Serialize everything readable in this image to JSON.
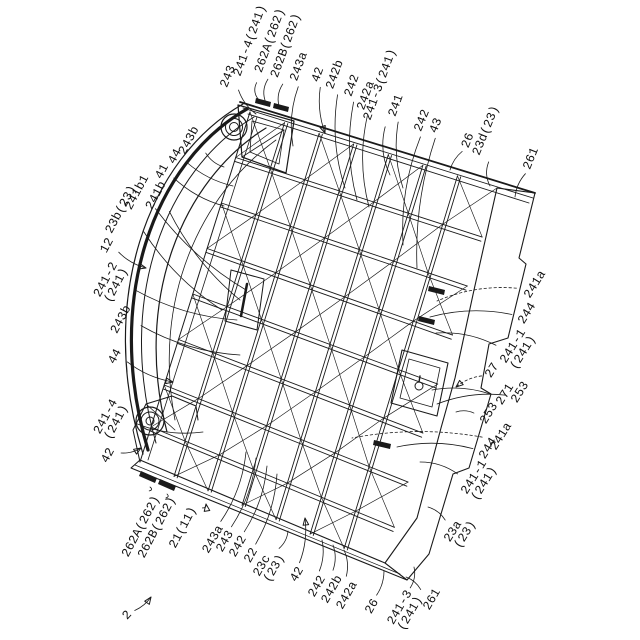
{
  "colors": {
    "ink": "#1a1a1a",
    "paper": "#ffffff"
  },
  "labels": [
    {
      "text": "243",
      "x": 229,
      "y": 77,
      "r": -68,
      "tx": 256,
      "ty": 114,
      "arrow": false,
      "dashed": false
    },
    {
      "text": "241-4(241)",
      "x": 251,
      "y": 41,
      "r": -70,
      "tx": 259,
      "ty": 100,
      "arrow": false,
      "dashed": false
    },
    {
      "text": "262A(262)",
      "x": 271,
      "y": 41,
      "r": -70,
      "tx": 266,
      "ty": 103,
      "arrow": false,
      "dashed": false
    },
    {
      "text": "262B(262)",
      "x": 287,
      "y": 46,
      "r": -70,
      "tx": 280,
      "ty": 109,
      "arrow": false,
      "dashed": false
    },
    {
      "text": "243a",
      "x": 300,
      "y": 67,
      "r": -70,
      "tx": 293,
      "ty": 146,
      "arrow": false,
      "dashed": false
    },
    {
      "text": "42",
      "x": 319,
      "y": 75,
      "r": -70,
      "tx": 325,
      "ty": 133,
      "arrow": true,
      "dashed": false
    },
    {
      "text": "242b",
      "x": 336,
      "y": 75,
      "r": -70,
      "tx": 345,
      "ty": 188,
      "arrow": false,
      "dashed": false
    },
    {
      "text": "242",
      "x": 353,
      "y": 86,
      "r": -70,
      "tx": 357,
      "ty": 200,
      "arrow": false,
      "dashed": false
    },
    {
      "text": "242a",
      "x": 367,
      "y": 96,
      "r": -70,
      "tx": 369,
      "ty": 207,
      "arrow": false,
      "dashed": false
    },
    {
      "text": "241-3(241)",
      "x": 381,
      "y": 85,
      "r": -70,
      "tx": 390,
      "ty": 175,
      "arrow": false,
      "dashed": false
    },
    {
      "text": "241",
      "x": 397,
      "y": 106,
      "r": -70,
      "tx": 403,
      "ty": 188,
      "arrow": false,
      "dashed": false
    },
    {
      "text": "242",
      "x": 423,
      "y": 121,
      "r": -68,
      "tx": 403,
      "ty": 245,
      "arrow": false,
      "dashed": false
    },
    {
      "text": "43",
      "x": 437,
      "y": 126,
      "r": -68,
      "tx": 417,
      "ty": 268,
      "arrow": false,
      "dashed": false
    },
    {
      "text": "26",
      "x": 469,
      "y": 141,
      "r": -68,
      "tx": 450,
      "ty": 170,
      "arrow": false,
      "dashed": false
    },
    {
      "text": "23d(23)",
      "x": 487,
      "y": 131,
      "r": -68,
      "tx": 490,
      "ty": 186,
      "arrow": false,
      "dashed": false
    },
    {
      "text": "261",
      "x": 532,
      "y": 159,
      "r": -68,
      "tx": 515,
      "ty": 197,
      "arrow": false,
      "dashed": false
    },
    {
      "text": "243b",
      "x": 190,
      "y": 141,
      "r": -62,
      "tx": 224,
      "ty": 167,
      "arrow": false,
      "dashed": false
    },
    {
      "text": "44",
      "x": 176,
      "y": 157,
      "r": -62,
      "tx": 233,
      "ty": 186,
      "arrow": false,
      "dashed": false
    },
    {
      "text": "41",
      "x": 163,
      "y": 172,
      "r": -62,
      "tx": 224,
      "ty": 206,
      "arrow": false,
      "dashed": false
    },
    {
      "text": "241b1",
      "x": 138,
      "y": 193,
      "r": -62,
      "tx": 246,
      "ty": 290,
      "arrow": false,
      "dashed": false
    },
    {
      "text": "241b",
      "x": 157,
      "y": 196,
      "r": -62,
      "tx": 240,
      "ty": 300,
      "arrow": false,
      "dashed": false
    },
    {
      "text": "23b(23)",
      "x": 122,
      "y": 210,
      "r": -62,
      "tx": 222,
      "ty": 310,
      "arrow": false,
      "dashed": false
    },
    {
      "text": "12",
      "x": 108,
      "y": 246,
      "r": -62,
      "tx": 146,
      "ty": 268,
      "arrow": true,
      "dashed": false
    },
    {
      "text": "241-2\n(241)",
      "x": 112,
      "y": 283,
      "r": -62,
      "tx": 237,
      "ty": 320,
      "arrow": false,
      "dashed": false
    },
    {
      "text": "243b",
      "x": 122,
      "y": 320,
      "r": -62,
      "tx": 240,
      "ty": 355,
      "arrow": false,
      "dashed": false
    },
    {
      "text": "44",
      "x": 116,
      "y": 357,
      "r": -62,
      "tx": 173,
      "ty": 382,
      "arrow": true,
      "dashed": false
    },
    {
      "text": "241-4\n(241)",
      "x": 112,
      "y": 420,
      "r": -62,
      "tx": 203,
      "ty": 432,
      "arrow": false,
      "dashed": false
    },
    {
      "text": "42",
      "x": 109,
      "y": 456,
      "r": -62,
      "tx": 141,
      "ty": 448,
      "arrow": true,
      "dashed": false
    },
    {
      "text": "262A(262)",
      "x": 142,
      "y": 527,
      "r": -62,
      "tx": 150,
      "ty": 487,
      "arrow": false,
      "dashed": false
    },
    {
      "text": "262B(262)",
      "x": 158,
      "y": 528,
      "r": -62,
      "tx": 167,
      "ty": 494,
      "arrow": false,
      "dashed": false
    },
    {
      "text": "21(11)",
      "x": 184,
      "y": 528,
      "r": -62,
      "tx": 206,
      "ty": 504,
      "arrow": true,
      "dashed": false
    },
    {
      "text": "243a",
      "x": 214,
      "y": 540,
      "r": -60,
      "tx": 246,
      "ty": 452,
      "arrow": false,
      "dashed": false
    },
    {
      "text": "243",
      "x": 226,
      "y": 542,
      "r": -60,
      "tx": 256,
      "ty": 458,
      "arrow": false,
      "dashed": false
    },
    {
      "text": "242",
      "x": 239,
      "y": 547,
      "r": -60,
      "tx": 267,
      "ty": 466,
      "arrow": false,
      "dashed": false
    },
    {
      "text": "22",
      "x": 252,
      "y": 556,
      "r": -60,
      "tx": 277,
      "ty": 474,
      "arrow": false,
      "dashed": false
    },
    {
      "text": "23c\n(23)",
      "x": 270,
      "y": 566,
      "r": -60,
      "tx": 288,
      "ty": 531,
      "arrow": false,
      "dashed": false
    },
    {
      "text": "42",
      "x": 298,
      "y": 575,
      "r": -60,
      "tx": 305,
      "ty": 518,
      "arrow": true,
      "dashed": false
    },
    {
      "text": "242",
      "x": 318,
      "y": 587,
      "r": -60,
      "tx": 322,
      "ty": 540,
      "arrow": false,
      "dashed": false
    },
    {
      "text": "242b",
      "x": 333,
      "y": 590,
      "r": -60,
      "tx": 333,
      "ty": 545,
      "arrow": false,
      "dashed": false
    },
    {
      "text": "242a",
      "x": 348,
      "y": 596,
      "r": -60,
      "tx": 344,
      "ty": 550,
      "arrow": false,
      "dashed": false
    },
    {
      "text": "26",
      "x": 373,
      "y": 607,
      "r": -60,
      "tx": 384,
      "ty": 571,
      "arrow": false,
      "dashed": false
    },
    {
      "text": "241-3\n(241)",
      "x": 406,
      "y": 611,
      "r": -60,
      "tx": 414,
      "ty": 567,
      "arrow": false,
      "dashed": false
    },
    {
      "text": "261",
      "x": 433,
      "y": 600,
      "r": -60,
      "tx": 406,
      "ty": 577,
      "arrow": false,
      "dashed": false
    },
    {
      "text": "23a\n(23)",
      "x": 461,
      "y": 532,
      "r": -58,
      "tx": 428,
      "ty": 507,
      "arrow": false,
      "dashed": false
    },
    {
      "text": "241-1\n(241)",
      "x": 480,
      "y": 481,
      "r": -58,
      "tx": 420,
      "ty": 462,
      "arrow": false,
      "dashed": false
    },
    {
      "text": "244",
      "x": 489,
      "y": 449,
      "r": -58,
      "tx": 397,
      "ty": 447,
      "arrow": false,
      "dashed": false
    },
    {
      "text": "241a",
      "x": 502,
      "y": 437,
      "r": -58,
      "tx": 352,
      "ty": 438,
      "arrow": false,
      "dashed": true
    },
    {
      "text": "253",
      "x": 490,
      "y": 414,
      "r": -58,
      "tx": 456,
      "ty": 412,
      "arrow": false,
      "dashed": false
    },
    {
      "text": "271",
      "x": 506,
      "y": 395,
      "r": -58,
      "tx": 432,
      "ty": 390,
      "arrow": false,
      "dashed": false
    },
    {
      "text": "27",
      "x": 493,
      "y": 371,
      "r": -58,
      "tx": 456,
      "ty": 387,
      "arrow": true,
      "dashed": true
    },
    {
      "text": "253",
      "x": 521,
      "y": 393,
      "r": -58,
      "tx": 437,
      "ty": 404,
      "arrow": false,
      "dashed": false
    },
    {
      "text": "241-1\n(241)",
      "x": 519,
      "y": 350,
      "r": -58,
      "tx": 436,
      "ty": 333,
      "arrow": false,
      "dashed": false
    },
    {
      "text": "244",
      "x": 528,
      "y": 314,
      "r": -58,
      "tx": 430,
      "ty": 317,
      "arrow": false,
      "dashed": false
    },
    {
      "text": "241a",
      "x": 536,
      "y": 285,
      "r": -58,
      "tx": 437,
      "ty": 301,
      "arrow": false,
      "dashed": true
    },
    {
      "text": "2",
      "x": 128,
      "y": 616,
      "r": -48,
      "tx": 151,
      "ty": 597,
      "arrow": true,
      "dashed": false
    }
  ]
}
